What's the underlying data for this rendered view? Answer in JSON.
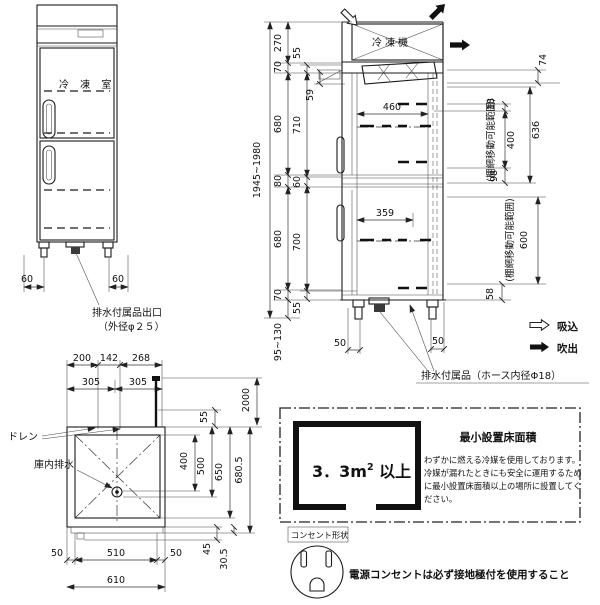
{
  "front_view": {
    "room_label": "冷 凍 室",
    "dim_leg_left": "60",
    "dim_leg_right": "60",
    "drain_outlet_label": "排水付属品出口",
    "drain_outlet_dia": "（外径φ２５）"
  },
  "side_view": {
    "condenser_label": "冷凍機",
    "overall_height": "1945~1980",
    "dims": {
      "h270": "270",
      "h70t": "70",
      "h55t": "55",
      "h59": "59",
      "h680t": "680",
      "h710": "710",
      "h80": "80",
      "h60": "60",
      "h680b": "680",
      "h700": "700",
      "h70b": "70",
      "h55b": "55",
      "legs": "95~130",
      "w460": "460",
      "w359": "359",
      "r74": "74",
      "r18": "18",
      "r400": "400",
      "r636": "636",
      "r98": "98",
      "r600": "600",
      "r58": "58",
      "leg50l": "50",
      "leg50r": "50"
    },
    "shelf_range_upper": "(棚網移動可能範囲)",
    "shelf_range_lower": "(棚網移動可能範囲)",
    "drain_hose_label": "排水付属品（ホース内径Φ18）",
    "legend_suction": "吸込",
    "legend_blowout": "吹出"
  },
  "plan_view": {
    "dims": {
      "t200": "200",
      "t142": "142",
      "t268": "268",
      "t305l": "305",
      "t305r": "305",
      "r2000": "2000",
      "r55": "55",
      "r400": "400",
      "r500": "500",
      "r650": "650",
      "r680_5": "680.5",
      "r45": "45",
      "r30_5": "30.5",
      "b50l": "50",
      "b510": "510",
      "b50r": "50",
      "b610": "610"
    },
    "drain_label": "ドレン",
    "interior_drain_label": "庫内排水"
  },
  "floor_area": {
    "heading": "最小設置床面積",
    "area_value": "3．3m",
    "area_sup": "2",
    "area_suffix": " 以上",
    "notes": [
      "わずかに燃える冷媒を使用しております。",
      "冷媒が漏れたときにも安全に運用するため",
      "に最小設置床面積以上の場所に設置してく",
      "ださい。"
    ]
  },
  "outlet": {
    "shape_label": "コンセント形状",
    "note": "電源コンセントは必ず接地極付を使用すること"
  }
}
